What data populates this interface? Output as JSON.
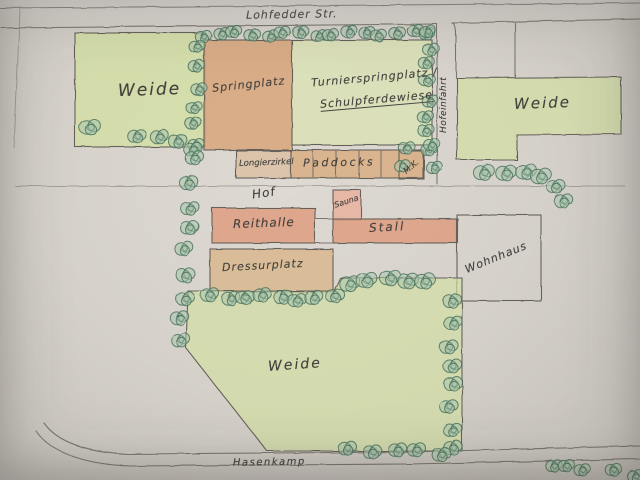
{
  "meta": {
    "title": "Hand-drawn site plan of an equestrian farm"
  },
  "colors": {
    "pencil": "#7b776e",
    "pencil_dark": "#66625a",
    "ink": "#45423e",
    "green_fill": "#d3dea4",
    "green_fill_light": "#dbe3b3",
    "orange_fill": "#d8a67b",
    "salmon_fill": "#de9d80",
    "sauna_fill": "#e8b4a1",
    "tan_fill": "#d9b88e",
    "paddock_fill": "#d9ab7d",
    "bush_fill": "#a9c4ab",
    "bush_stroke": "#4a735e"
  },
  "streets": {
    "top": {
      "label": "Lohfedder Str."
    },
    "bottom": {
      "label": "Hasenkamp"
    }
  },
  "areas": {
    "weide_left": {
      "label": "Weide"
    },
    "springplatz": {
      "label": "Springplatz"
    },
    "turnierplatz": {
      "label_line1": "Turnierspringplatz /",
      "label_line2": "Schulpferdewiese"
    },
    "longierzirkel": {
      "label": "Longierzirkel"
    },
    "paddocks": {
      "label": "Paddocks"
    },
    "mk": {
      "label": "M.K."
    },
    "hofeinfahrt": {
      "label": "Hofeinfahrt"
    },
    "weide_right": {
      "label": "Weide"
    },
    "hof": {
      "label": "Hof"
    },
    "reithalle": {
      "label": "Reithalle"
    },
    "sauna": {
      "label": "Sauna"
    },
    "stall": {
      "label": "Stall"
    },
    "wohnhaus": {
      "label": "Wohnhaus"
    },
    "dressurplatz": {
      "label": "Dressurplatz"
    },
    "weide_bottom": {
      "label": "Weide"
    }
  },
  "decor": {
    "hedges": [
      {
        "x1": 204,
        "y1": 34,
        "x2": 430,
        "y2": 33,
        "n": 15,
        "r": 7
      },
      {
        "x1": 199,
        "y1": 48,
        "x2": 194,
        "y2": 145,
        "n": 6,
        "r": 7
      },
      {
        "x1": 88,
        "y1": 127,
        "x2": 88,
        "y2": 127,
        "n": 1,
        "r": 9
      },
      {
        "x1": 140,
        "y1": 134,
        "x2": 196,
        "y2": 147,
        "n": 4,
        "r": 8
      },
      {
        "x1": 193,
        "y1": 160,
        "x2": 181,
        "y2": 342,
        "n": 9,
        "r": 8
      },
      {
        "x1": 429,
        "y1": 30,
        "x2": 427,
        "y2": 150,
        "n": 8,
        "r": 7
      },
      {
        "x1": 408,
        "y1": 147,
        "x2": 434,
        "y2": 147,
        "n": 2,
        "r": 7
      },
      {
        "x1": 401,
        "y1": 168,
        "x2": 434,
        "y2": 166,
        "n": 2,
        "r": 7
      },
      {
        "x1": 487,
        "y1": 170,
        "x2": 544,
        "y2": 176,
        "n": 4,
        "r": 9
      },
      {
        "x1": 554,
        "y1": 187,
        "x2": 566,
        "y2": 203,
        "n": 2,
        "r": 8
      },
      {
        "x1": 212,
        "y1": 296,
        "x2": 333,
        "y2": 298,
        "n": 8,
        "r": 8
      },
      {
        "x1": 350,
        "y1": 281,
        "x2": 428,
        "y2": 279,
        "n": 5,
        "r": 9
      },
      {
        "x1": 452,
        "y1": 303,
        "x2": 452,
        "y2": 448,
        "n": 8,
        "r": 8
      },
      {
        "x1": 350,
        "y1": 448,
        "x2": 442,
        "y2": 453,
        "n": 5,
        "r": 8
      },
      {
        "x1": 552,
        "y1": 464,
        "x2": 584,
        "y2": 471,
        "n": 3,
        "r": 7
      },
      {
        "x1": 616,
        "y1": 472,
        "x2": 634,
        "y2": 476,
        "n": 2,
        "r": 7
      }
    ]
  }
}
